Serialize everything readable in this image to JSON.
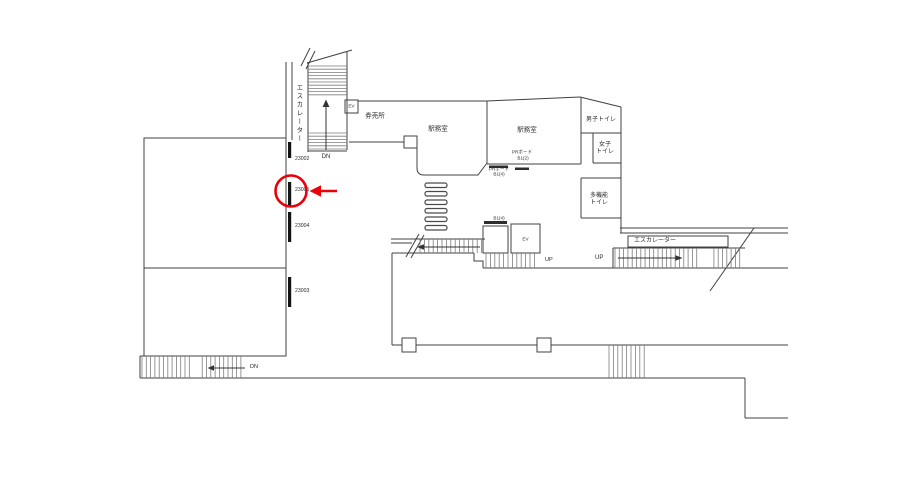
{
  "floorplan": {
    "upper": {
      "escalator": "エスカレーター",
      "stairs_direction": "DN",
      "elevator": "EV",
      "ticket_office": "券売所",
      "station_office_left": "駅務室",
      "station_office_right": "駅務室"
    },
    "pr_boards": {
      "board_b12": {
        "line1": "PRボード",
        "line2": "B1(2)"
      },
      "board_b14": {
        "line1": "PRボード",
        "line2": "B1(4)"
      },
      "board_b14_tag": "B1(4)"
    },
    "toilets": {
      "mens": "男子トイレ",
      "womens_line1": "女子",
      "womens_line2": "トイレ",
      "multi_line1": "多機能",
      "multi_line2": "トイレ"
    },
    "center": {
      "elevator": "EV",
      "stairs_direction": "UP"
    },
    "right": {
      "escalator": "エスカレーター",
      "stairs_direction": "UP"
    },
    "bottom": {
      "stairs_direction": "DN"
    },
    "signs": [
      {
        "id": "23002",
        "highlighted": false
      },
      {
        "id": "23005",
        "highlighted": true
      },
      {
        "id": "23004",
        "highlighted": false
      },
      {
        "id": "23003",
        "highlighted": false
      }
    ],
    "annotation": {
      "color": "#e8000b"
    }
  }
}
